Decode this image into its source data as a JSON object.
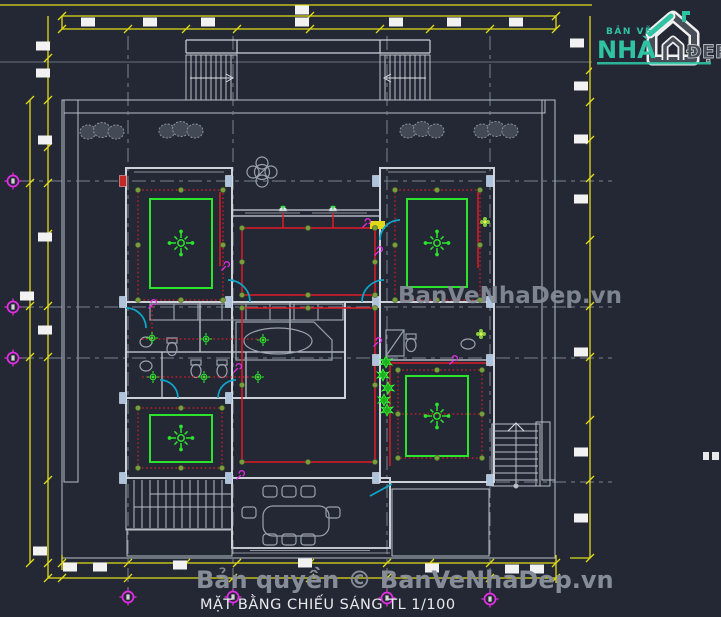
{
  "title": "MẶT BẰNG CHIẾU SÁNG TL 1/100",
  "watermarks": {
    "center": "BanVeNhaDep.vn",
    "bottom": "Bản quyền © BanVeNhaDep.vn"
  },
  "logo": {
    "tagline": "BẢN VẼ",
    "name_left": "NHÀ",
    "name_right": "ĐẸP"
  },
  "colors": {
    "background": "#232834",
    "dim_yellow": "#e0da18",
    "wall": "#cdd2d9",
    "grid": "#7c838e",
    "wire_red": "#e01a28",
    "bright_green": "#2de42d",
    "downlight_olive": "#7b9e3c",
    "switch_magenta": "#e62ee6",
    "door_cyan": "#0fa6c9",
    "furniture_gray": "#9aa1ab",
    "watermark_gray": "#878d98",
    "logo_teal": "#2fc3a3",
    "logo_gray": "#474d57",
    "title_white": "#e8eaec"
  },
  "stamp_map": {
    "ceiling_lights": "sym-clight",
    "bath_lights": "sym-blight",
    "wall_lights": "sym-wlight",
    "downlights": "sym-downlight",
    "switches": "sym-switch",
    "axis_bubbles": "sym-bubble",
    "dim_blocks": "sym-dimblock",
    "columns_blue": "sym-colblue",
    "columns_red": "sym-colred",
    "bushes": "sym-bush",
    "chairs": "sym-chair",
    "plants_column": "sym-plant",
    "small_flowers": "sym-flower"
  },
  "drawing": {
    "ceiling_lights": [
      [
        181,
        243
      ],
      [
        437,
        243
      ],
      [
        181,
        438
      ],
      [
        437,
        416
      ]
    ],
    "bath_lights": [
      [
        152,
        338
      ],
      [
        206,
        339
      ],
      [
        263,
        340
      ],
      [
        153,
        377
      ],
      [
        204,
        377
      ],
      [
        258,
        377
      ]
    ],
    "wall_lights": [
      [
        283,
        211
      ],
      [
        333,
        211
      ]
    ],
    "downlights": [
      [
        138,
        190
      ],
      [
        181,
        190
      ],
      [
        223,
        190
      ],
      [
        138,
        245
      ],
      [
        223,
        245
      ],
      [
        138,
        300
      ],
      [
        181,
        300
      ],
      [
        223,
        300
      ],
      [
        395,
        190
      ],
      [
        437,
        190
      ],
      [
        480,
        190
      ],
      [
        395,
        245
      ],
      [
        480,
        245
      ],
      [
        395,
        300
      ],
      [
        437,
        300
      ],
      [
        480,
        300
      ],
      [
        242,
        228
      ],
      [
        308,
        228
      ],
      [
        375,
        228
      ],
      [
        242,
        262
      ],
      [
        375,
        262
      ],
      [
        242,
        295
      ],
      [
        308,
        295
      ],
      [
        375,
        295
      ],
      [
        242,
        308
      ],
      [
        308,
        308
      ],
      [
        375,
        308
      ],
      [
        242,
        385
      ],
      [
        375,
        385
      ],
      [
        242,
        462
      ],
      [
        308,
        462
      ],
      [
        375,
        462
      ],
      [
        138,
        408
      ],
      [
        181,
        408
      ],
      [
        222,
        408
      ],
      [
        138,
        468
      ],
      [
        181,
        468
      ],
      [
        222,
        468
      ],
      [
        398,
        370
      ],
      [
        437,
        370
      ],
      [
        482,
        370
      ],
      [
        398,
        414
      ],
      [
        482,
        414
      ],
      [
        398,
        458
      ],
      [
        437,
        458
      ],
      [
        482,
        458
      ]
    ],
    "switches": [
      [
        225,
        267
      ],
      [
        366,
        224
      ],
      [
        378,
        252
      ],
      [
        377,
        343
      ],
      [
        453,
        361
      ],
      [
        237,
        369
      ],
      [
        152,
        305
      ],
      [
        240,
        476
      ]
    ],
    "axis_bubbles": [
      [
        13,
        181
      ],
      [
        13,
        307
      ],
      [
        13,
        358
      ],
      [
        128,
        597
      ],
      [
        233,
        597
      ],
      [
        387,
        598
      ],
      [
        490,
        599
      ]
    ],
    "dim_blocks": [
      [
        88,
        22
      ],
      [
        150,
        22
      ],
      [
        208,
        22
      ],
      [
        302,
        22
      ],
      [
        396,
        22
      ],
      [
        454,
        22
      ],
      [
        516,
        22
      ],
      [
        302,
        10
      ],
      [
        43,
        46
      ],
      [
        43,
        73
      ],
      [
        45,
        140
      ],
      [
        45,
        237
      ],
      [
        27,
        296
      ],
      [
        45,
        330
      ],
      [
        40,
        551
      ],
      [
        577,
        43
      ],
      [
        581,
        86
      ],
      [
        581,
        139
      ],
      [
        581,
        199
      ],
      [
        581,
        352
      ],
      [
        581,
        452
      ],
      [
        581,
        518
      ],
      [
        70,
        567
      ],
      [
        100,
        567
      ],
      [
        180,
        565
      ],
      [
        305,
        563
      ],
      [
        432,
        568
      ],
      [
        512,
        569
      ],
      [
        537,
        569
      ]
    ],
    "columns_blue": [
      [
        229,
        181
      ],
      [
        376,
        181
      ],
      [
        490,
        181
      ],
      [
        123,
        302
      ],
      [
        229,
        302
      ],
      [
        376,
        302
      ],
      [
        490,
        302
      ],
      [
        123,
        398
      ],
      [
        229,
        398
      ],
      [
        123,
        478
      ],
      [
        229,
        478
      ],
      [
        376,
        478
      ],
      [
        490,
        480
      ],
      [
        376,
        360
      ],
      [
        490,
        360
      ]
    ],
    "columns_red": [
      [
        123,
        181
      ]
    ],
    "bushes": [
      [
        88,
        130
      ],
      [
        167,
        129
      ],
      [
        408,
        129
      ],
      [
        482,
        129
      ]
    ],
    "chairs": [
      [
        270,
        491
      ],
      [
        289,
        491
      ],
      [
        308,
        491
      ],
      [
        270,
        539
      ],
      [
        289,
        539
      ],
      [
        308,
        539
      ],
      [
        249,
        512
      ],
      [
        333,
        512
      ]
    ],
    "plants_column": [
      [
        386,
        362
      ],
      [
        383,
        375
      ],
      [
        388,
        388
      ],
      [
        384,
        400
      ],
      [
        387,
        410
      ]
    ],
    "small_flowers": [
      [
        485,
        222
      ],
      [
        481,
        334
      ]
    ]
  }
}
